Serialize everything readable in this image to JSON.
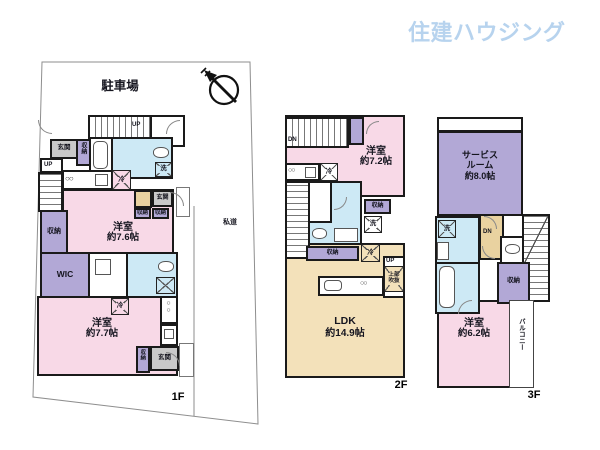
{
  "logo": {
    "text": "住建ハウジング",
    "color": "#b7d3ee"
  },
  "icons": {
    "burners": "○○"
  },
  "colors": {
    "room_pink": "#f8d9e7",
    "water_blue": "#cde9f5",
    "closet_purple": "#b2a8d6",
    "ldk_beige": "#f3e1ba",
    "entry_gray": "#c9c9c9",
    "tan": "#e9d2a0",
    "logo_blue": "#b7d3ee"
  },
  "floor1": {
    "floor_label": "1F",
    "parking": "駐車場",
    "road": "私道",
    "genkan_top": "玄関",
    "closet_top": "収納",
    "up_top": "UP",
    "up_left": "UP",
    "fridge_top": "冷",
    "laundry": "洗",
    "bedroom1": {
      "name": "洋室",
      "size": "約7.6帖"
    },
    "closet_left": "収納",
    "wic": "WIC",
    "genkan_mid": "玄関",
    "closet_mid_a": "収納",
    "closet_mid_b": "収納",
    "fridge_low": "冷",
    "bedroom2": {
      "name": "洋室",
      "size": "約7.7帖"
    },
    "closet_bottom": "収納",
    "genkan_bottom": "玄関"
  },
  "floor2": {
    "floor_label": "2F",
    "dn": "DN",
    "up": "UP",
    "fridge_top": "冷",
    "bedroom": {
      "name": "洋室",
      "size": "約7.2帖"
    },
    "closet_right": "収納",
    "laundry": "洗",
    "closet_mid": "収納",
    "fridge_mid": "冷",
    "void_note_1": "上部",
    "void_note_2": "吹抜",
    "ldk": {
      "name": "LDK",
      "size": "約14.9帖"
    }
  },
  "floor3": {
    "floor_label": "3F",
    "service_room": {
      "name_1": "サービス",
      "name_2": "ルーム",
      "size": "約8.0帖"
    },
    "laundry": "洗",
    "dn": "DN",
    "closet": "収納",
    "bedroom": {
      "name": "洋室",
      "size": "約6.2帖"
    },
    "balcony": "バルコニー"
  }
}
